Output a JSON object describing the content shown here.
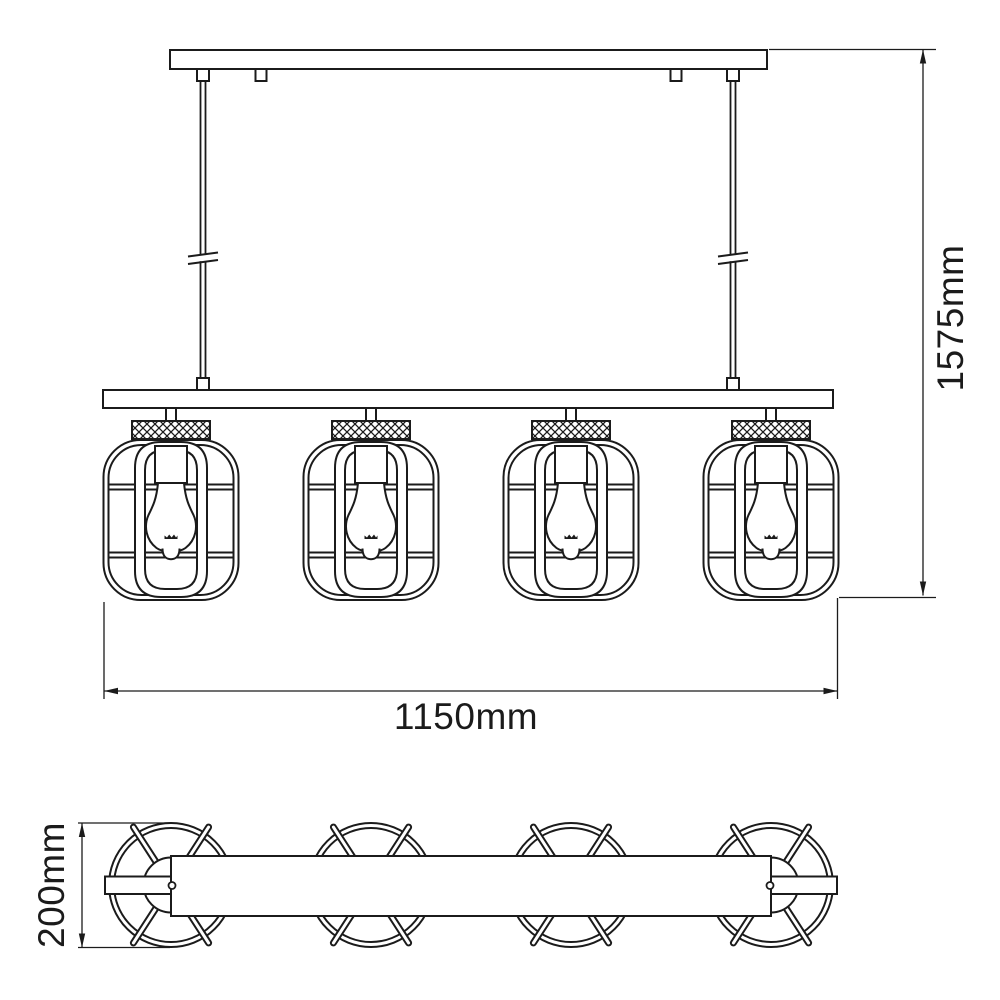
{
  "page": {
    "background_color": "#ffffff",
    "line_color": "#1b1b1b"
  },
  "drawing": {
    "kind": "pendant-light-dimension-drawing",
    "lamp_count": 4,
    "views": [
      "front-elevation",
      "bottom-plan"
    ]
  },
  "dimensions": {
    "overall_height_label": "1575mm",
    "overall_width_label": "1150mm",
    "bar_depth_label": "200mm"
  }
}
